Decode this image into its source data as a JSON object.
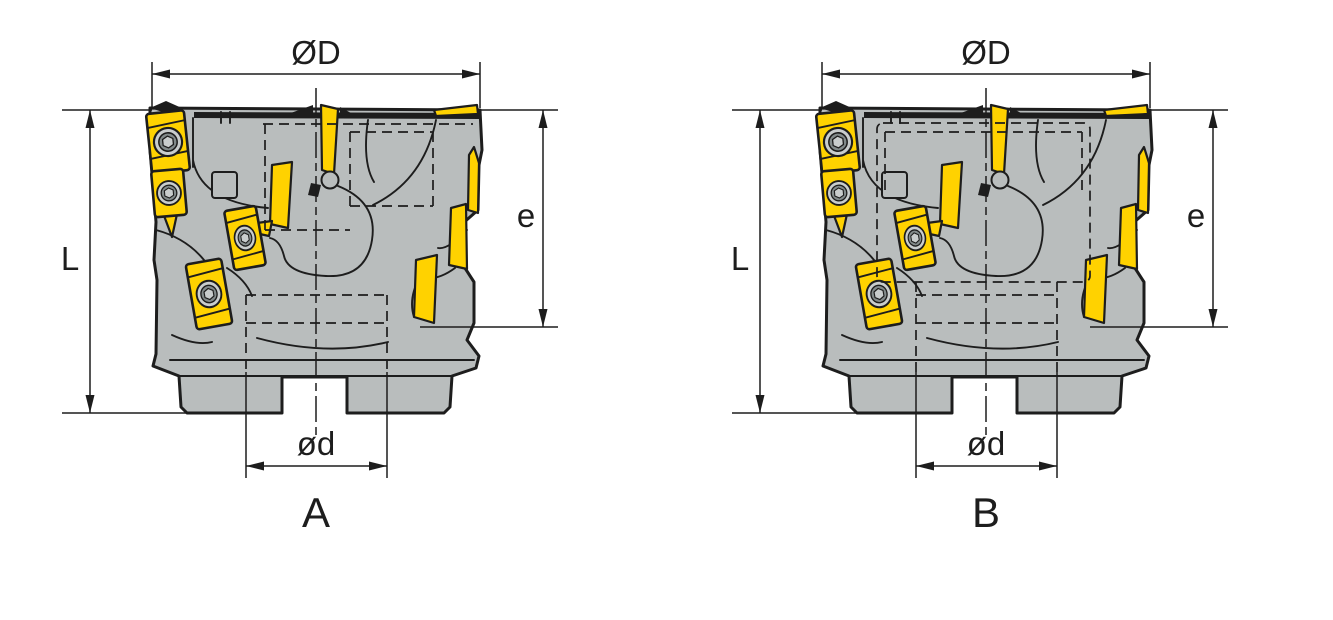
{
  "drawing": {
    "type": "technical-drawing",
    "subject": "indexable face milling cutter, front views",
    "view_count": 2
  },
  "figures": {
    "a": {
      "letter": "A",
      "dim_top": "ØD",
      "dim_left": "L",
      "dim_right": "e",
      "dim_bottom": "ød"
    },
    "b": {
      "letter": "B",
      "dim_top": "ØD",
      "dim_left": "L",
      "dim_right": "e",
      "dim_bottom": "ød"
    }
  },
  "colors": {
    "background": "#ffffff",
    "line": "#1d1d1d",
    "body": "#b9bdbd",
    "insert": "#ffd200",
    "screw_face": "#c9cdcd",
    "screw_ring": "#828a8a"
  }
}
